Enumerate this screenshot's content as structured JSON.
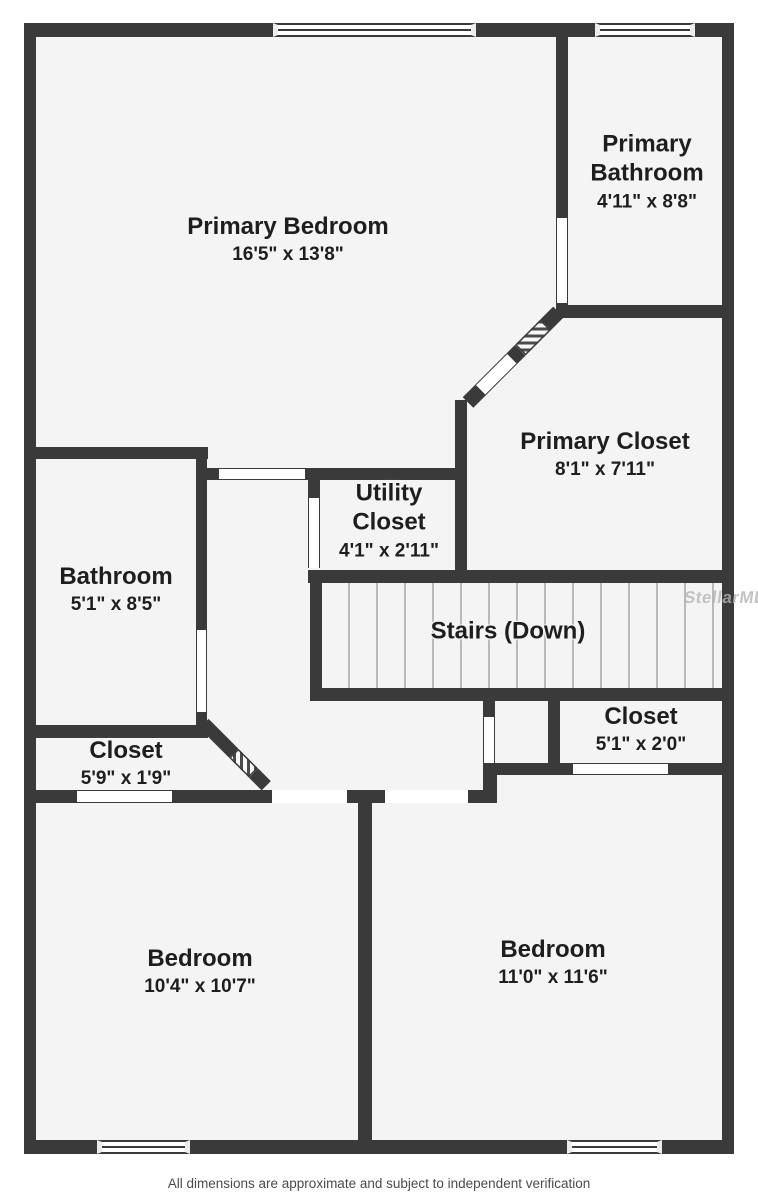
{
  "rooms": [
    {
      "name": "Primary Bedroom",
      "dims": "16'5\" x 13'8\""
    },
    {
      "name": "Primary Bathroom",
      "dims": "4'11\" x 8'8\""
    },
    {
      "name": "Primary Closet",
      "dims": "8'1\" x 7'11\""
    },
    {
      "name": "Utility Closet",
      "dims": "4'1\" x 2'11\""
    },
    {
      "name": "Bathroom",
      "dims": "5'1\" x 8'5\""
    },
    {
      "name": "Stairs (Down)",
      "dims": ""
    },
    {
      "name": "Closet",
      "dims": "5'9\" x 1'9\""
    },
    {
      "name": "Closet",
      "dims": "5'1\" x 2'0\""
    },
    {
      "name": "Bedroom",
      "dims": "10'4\" x 10'7\""
    },
    {
      "name": "Bedroom",
      "dims": "11'0\" x 11'6\""
    }
  ],
  "watermark": "StellarMLS",
  "footer": "All dimensions are approximate and subject to independent verification",
  "colors": {
    "wall": "#3a3a3a",
    "floor": "#f4f4f4",
    "tread_line": "#b9b9b9",
    "text": "#1e1e1e"
  }
}
